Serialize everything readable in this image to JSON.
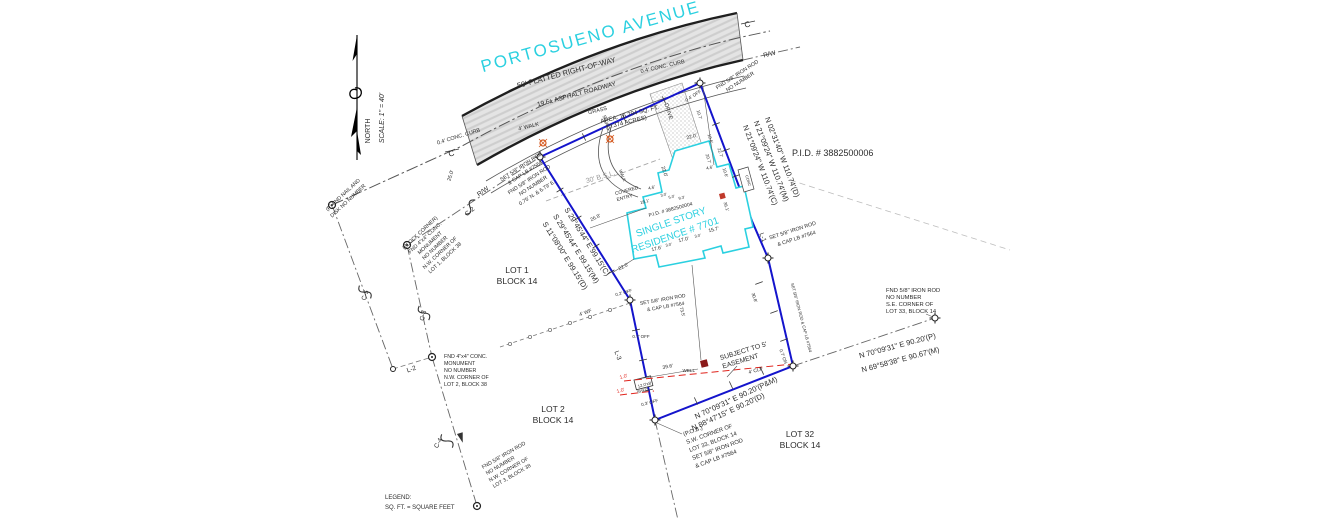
{
  "colors": {
    "ink": "#2b2b2b",
    "grey": "#9a9a9a",
    "cyan": "#2bd0e0",
    "red": "#e0231c",
    "blue": "#1414cc",
    "road_fill": "#e4e4e4",
    "well_fill": "#8b1a1a",
    "ac_fill": "#c0392b",
    "orange": "#d4581e"
  },
  "labels": [
    {
      "n": "road-name",
      "t": "PORTOSUENO AVENUE",
      "x": 592,
      "y": 42,
      "r": -15.5,
      "s": 17,
      "c": "cyan",
      "ls": 2
    },
    {
      "n": "road-row-width",
      "t": "50' PLATTED RIGHT-OF-WAY",
      "x": 567,
      "y": 75,
      "r": -15,
      "s": 7.5
    },
    {
      "n": "road-asphalt",
      "t": "19.6± ASPHALT ROADWAY",
      "x": 577,
      "y": 96,
      "r": -15,
      "s": 6.5
    },
    {
      "n": "curb-note-north",
      "t": "0.4' CONC. CURB",
      "x": 459,
      "y": 138,
      "r": -17,
      "s": 5.5
    },
    {
      "n": "curb-note-south",
      "t": "0.4' CONC. CURB",
      "x": 663,
      "y": 68,
      "r": -13,
      "s": 5.5
    },
    {
      "n": "grass-label",
      "t": "GRASS",
      "x": 598,
      "y": 112,
      "r": -14,
      "s": 5.5
    },
    {
      "n": "walk-label",
      "t": "4' WALK",
      "x": 529,
      "y": 128,
      "r": -14,
      "s": 5.5
    },
    {
      "n": "swale-label",
      "t": "SWALE",
      "x": 605,
      "y": 124,
      "r": 72,
      "s": 5
    },
    {
      "n": "drive-label",
      "t": "DRIVE",
      "x": 667,
      "y": 112,
      "r": 72,
      "s": 5.5
    },
    {
      "n": "north-label",
      "t": "NORTH",
      "x": 370,
      "y": 131,
      "r": -90,
      "s": 7
    },
    {
      "n": "scale-label",
      "t": "SCALE: 1\" = 40'",
      "x": 384,
      "y": 118,
      "r": -90,
      "s": 7,
      "i": 1
    },
    {
      "n": "pid-parcel",
      "t": "P.I.D.  #   3882500006",
      "x": 792,
      "y": 156,
      "s": 9,
      "a": "s"
    },
    {
      "n": "area-line1",
      "t": "AREA: 16,294 SQ. FT.",
      "x": 630,
      "y": 116,
      "r": -14,
      "s": 6
    },
    {
      "n": "area-line2",
      "t": "(0.374 ACRES)",
      "x": 627,
      "y": 124,
      "r": -14,
      "s": 6
    },
    {
      "n": "bsl-label",
      "t": "30' B.S.L.",
      "x": 601,
      "y": 179,
      "r": -16,
      "s": 7,
      "c": "grey"
    },
    {
      "n": "rw-label-ne",
      "t": "R/W",
      "x": 770,
      "y": 56,
      "r": -14,
      "s": 6.5
    },
    {
      "n": "centerline-c-west",
      "t": "C",
      "x": 452,
      "y": 156,
      "r": -15,
      "s": 8
    },
    {
      "n": "centerline-c-east",
      "t": "C",
      "x": 748,
      "y": 27,
      "r": -15,
      "s": 8
    },
    {
      "n": "nw-rod-1",
      "t": "SET 5/8\" IRON ROD",
      "x": 522,
      "y": 168,
      "r": -33,
      "s": 5.3
    },
    {
      "n": "nw-rod-2",
      "t": "& CAP LB #7564",
      "x": 526,
      "y": 174,
      "r": -33,
      "s": 5.3
    },
    {
      "n": "nw-rod-3",
      "t": "FND 5/8\" IRON ROD",
      "x": 530,
      "y": 181,
      "r": -33,
      "s": 5.3
    },
    {
      "n": "nw-rod-4",
      "t": "NO NUMBER",
      "x": 534,
      "y": 187,
      "r": -33,
      "s": 5.3
    },
    {
      "n": "nw-rod-5",
      "t": "0.75' N. & 6.79' E.",
      "x": 538,
      "y": 194,
      "r": -33,
      "s": 5.3
    },
    {
      "n": "rw-label-west",
      "t": "R/W",
      "x": 484,
      "y": 193,
      "r": -35,
      "s": 6.5
    },
    {
      "n": "curve-label-c2",
      "t": "C-2",
      "x": 471,
      "y": 213,
      "r": -40,
      "s": 6.5
    },
    {
      "n": "dim-25",
      "t": "25.0'",
      "x": 452,
      "y": 176,
      "r": -73,
      "s": 5.2
    },
    {
      "n": "nail-disk-1",
      "t": "(P) FND NAIL AND",
      "x": 344,
      "y": 196,
      "r": -43,
      "s": 5.3
    },
    {
      "n": "nail-disk-2",
      "t": "DISK NO NUMBER",
      "x": 349,
      "y": 202,
      "r": -43,
      "s": 5.3
    },
    {
      "n": "block-corner-1",
      "t": "(BLOCK CORNER)",
      "x": 421,
      "y": 234,
      "r": -43,
      "s": 5.3
    },
    {
      "n": "block-corner-2",
      "t": "FND 4\"x4\" CONC.",
      "x": 426,
      "y": 239,
      "r": -43,
      "s": 5.3
    },
    {
      "n": "block-corner-3",
      "t": "MONUMENT",
      "x": 431,
      "y": 244,
      "r": -43,
      "s": 5.3
    },
    {
      "n": "block-corner-4",
      "t": "NO NUMBER",
      "x": 436,
      "y": 249,
      "r": -43,
      "s": 5.3
    },
    {
      "n": "block-corner-5",
      "t": "N.W. CORNER OF",
      "x": 441,
      "y": 254,
      "r": -43,
      "s": 5.3
    },
    {
      "n": "block-corner-6",
      "t": "LOT 1, BLOCK 38",
      "x": 446,
      "y": 259,
      "r": -43,
      "s": 5.3
    },
    {
      "n": "curve-label-c5",
      "t": "C-5",
      "x": 367,
      "y": 296,
      "r": -70,
      "s": 6.5
    },
    {
      "n": "curve-label-c3",
      "t": "C-3",
      "x": 425,
      "y": 316,
      "r": -76,
      "s": 6.5
    },
    {
      "n": "lot2-mon-1",
      "t": "FND 4\"x4\" CONC.",
      "x": 444,
      "y": 358,
      "s": 5.3,
      "a": "s"
    },
    {
      "n": "lot2-mon-2",
      "t": "MONUMENT",
      "x": 444,
      "y": 365,
      "s": 5.3,
      "a": "s"
    },
    {
      "n": "lot2-mon-3",
      "t": "NO NUMBER",
      "x": 444,
      "y": 372,
      "s": 5.3,
      "a": "s"
    },
    {
      "n": "lot2-mon-4",
      "t": "N.W. CORNER OF",
      "x": 444,
      "y": 379,
      "s": 5.3,
      "a": "s"
    },
    {
      "n": "lot2-mon-5",
      "t": "LOT 2, BLOCK 38",
      "x": 444,
      "y": 386,
      "s": 5.3,
      "a": "s"
    },
    {
      "n": "line-label-l2",
      "t": "L-2",
      "x": 412,
      "y": 371,
      "r": -18,
      "s": 6.5
    },
    {
      "n": "curve-label-c4",
      "t": "C-4",
      "x": 440,
      "y": 444,
      "r": -62,
      "s": 6.5
    },
    {
      "n": "lot3-rod-1",
      "t": "FND 5/8\" IRON ROD",
      "x": 483,
      "y": 469,
      "r": -30,
      "s": 5.3,
      "a": "s"
    },
    {
      "n": "lot3-rod-2",
      "t": "NO NUMBER",
      "x": 487,
      "y": 475,
      "r": -30,
      "s": 5.3,
      "a": "s"
    },
    {
      "n": "lot3-rod-3",
      "t": "N.W. CORNER OF",
      "x": 490,
      "y": 482,
      "r": -30,
      "s": 5.3,
      "a": "s"
    },
    {
      "n": "lot3-rod-4",
      "t": "LOT 3, BLOCK 38",
      "x": 494,
      "y": 488,
      "r": -30,
      "s": 5.3,
      "a": "s"
    },
    {
      "n": "legend-title",
      "t": "LEGEND:",
      "x": 385,
      "y": 499,
      "s": 6,
      "a": "s"
    },
    {
      "n": "legend-line",
      "t": "SQ. FT. = SQUARE FEET",
      "x": 385,
      "y": 509,
      "s": 6,
      "a": "s"
    },
    {
      "n": "lot1-label",
      "t": "LOT 1",
      "x": 517,
      "y": 273,
      "s": 8.5
    },
    {
      "n": "lot1-block",
      "t": "BLOCK 14",
      "x": 517,
      "y": 284,
      "s": 8.5
    },
    {
      "n": "lot2-label",
      "t": "LOT 2",
      "x": 553,
      "y": 412,
      "s": 8.5
    },
    {
      "n": "lot2-block",
      "t": "BLOCK 14",
      "x": 553,
      "y": 423,
      "s": 8.5
    },
    {
      "n": "lot32-label",
      "t": "LOT 32",
      "x": 800,
      "y": 437,
      "s": 8.5
    },
    {
      "n": "lot32-block",
      "t": "BLOCK 14",
      "x": 800,
      "y": 448,
      "s": 8.5
    },
    {
      "n": "bearing-west-c",
      "t": "S 29°45'44\" E   99.15'(C)",
      "x": 585,
      "y": 243,
      "r": 58,
      "s": 7.5
    },
    {
      "n": "bearing-west-m",
      "t": "S 29°45'44\" E   99.15'(M)",
      "x": 574,
      "y": 250,
      "r": 58,
      "s": 7.5
    },
    {
      "n": "bearing-west-d",
      "t": "S 11°08'00\" E   99.15'(D)",
      "x": 563,
      "y": 257,
      "r": 58,
      "s": 7.5
    },
    {
      "n": "bearing-east-d",
      "t": "N 02°31'40\" W   110.74'(D)",
      "x": 780,
      "y": 158,
      "r": 69,
      "s": 7.5
    },
    {
      "n": "bearing-east-m",
      "t": "N 21°09'24\" W   110.74'(M)",
      "x": 769,
      "y": 162,
      "r": 69,
      "s": 7.5
    },
    {
      "n": "bearing-east-c",
      "t": "N 21°09'24\" W   110.74'(C)",
      "x": 758,
      "y": 166,
      "r": 69,
      "s": 7.5
    },
    {
      "n": "bearing-south-pm",
      "t": "N 70°09'31\" E   90.20'(P&M)",
      "x": 737,
      "y": 400,
      "r": -25,
      "s": 7.5
    },
    {
      "n": "bearing-south-d",
      "t": "N 88°47'15\" E   90.20'(D)",
      "x": 729,
      "y": 414,
      "r": -25,
      "s": 7.5
    },
    {
      "n": "bearing-se-p",
      "t": "N 70°09'31\" E   90.20'(P)",
      "x": 898,
      "y": 348,
      "r": -15,
      "s": 7.5
    },
    {
      "n": "bearing-se-m",
      "t": "N 69°58'38\" E   90.67'(M)",
      "x": 901,
      "y": 362,
      "r": -15,
      "s": 7.5
    },
    {
      "n": "pob-1",
      "t": "(P.O.B.)",
      "x": 684,
      "y": 436,
      "r": -20,
      "s": 5.8,
      "a": "s"
    },
    {
      "n": "pob-2",
      "t": "S.W. CORNER OF",
      "x": 687,
      "y": 444,
      "r": -20,
      "s": 5.8,
      "a": "s"
    },
    {
      "n": "pob-3",
      "t": "LOT 33, BLOCK 14",
      "x": 690,
      "y": 452,
      "r": -20,
      "s": 5.8,
      "a": "s"
    },
    {
      "n": "pob-4",
      "t": "SET 5/8\" IRON ROD",
      "x": 693,
      "y": 460,
      "r": -20,
      "s": 5.8,
      "a": "s"
    },
    {
      "n": "pob-5",
      "t": "& CAP LB #7564",
      "x": 696,
      "y": 468,
      "r": -20,
      "s": 5.8,
      "a": "s"
    },
    {
      "n": "se-rod-1",
      "t": "FND 5/8\" IRON ROD",
      "x": 886,
      "y": 292,
      "s": 5.8,
      "a": "s"
    },
    {
      "n": "se-rod-2",
      "t": "NO NUMBER",
      "x": 886,
      "y": 299,
      "s": 5.8,
      "a": "s"
    },
    {
      "n": "se-rod-3",
      "t": "S.E. CORNER OF",
      "x": 886,
      "y": 306,
      "s": 5.8,
      "a": "s"
    },
    {
      "n": "se-rod-4",
      "t": "LOT 33, BLOCK 14",
      "x": 886,
      "y": 313,
      "s": 5.8,
      "a": "s"
    },
    {
      "n": "midright-rod-1",
      "t": "SET 5/8\" IRON ROD",
      "x": 793,
      "y": 232,
      "r": -18,
      "s": 5.3
    },
    {
      "n": "midright-rod-2",
      "t": "& CAP LB #7564",
      "x": 797,
      "y": 240,
      "r": -18,
      "s": 5.3
    },
    {
      "n": "line-label-l1",
      "t": "L-1",
      "x": 761,
      "y": 238,
      "r": 70,
      "s": 6.5
    },
    {
      "n": "ne-rod-1",
      "t": "FND 5/8\" IRON ROD",
      "x": 738,
      "y": 76,
      "r": -33,
      "s": 5.3
    },
    {
      "n": "ne-rod-2",
      "t": "NO NUMBER",
      "x": 741,
      "y": 83,
      "r": -33,
      "s": 5.3
    },
    {
      "n": "ne-rod-off",
      "t": "0.4' OFF",
      "x": 694,
      "y": 97,
      "r": -33,
      "s": 4.6
    },
    {
      "n": "easement-1",
      "t": "SUBJECT TO 5'",
      "x": 744,
      "y": 353,
      "r": -17,
      "s": 6.8
    },
    {
      "n": "easement-2",
      "t": "EASEMENT",
      "x": 741,
      "y": 363,
      "r": -17,
      "s": 6.8
    },
    {
      "n": "clf-label",
      "t": "4' CLF",
      "x": 756,
      "y": 372,
      "r": -16,
      "s": 5
    },
    {
      "n": "fence-off-1",
      "t": "1.0'",
      "x": 624,
      "y": 378,
      "r": -15,
      "s": 5,
      "c": "red"
    },
    {
      "n": "fence-off-2",
      "t": "1.0'",
      "x": 621,
      "y": 392,
      "r": -15,
      "s": 5,
      "c": "red"
    },
    {
      "n": "shed-size",
      "t": "12.0'x8'",
      "x": 645,
      "y": 386,
      "r": -14,
      "s": 4.2
    },
    {
      "n": "shed-label",
      "t": "SHED",
      "x": 643,
      "y": 392,
      "r": -14,
      "s": 4.2
    },
    {
      "n": "off-03",
      "t": "0.3' OFF",
      "x": 650,
      "y": 404,
      "r": -15,
      "s": 4.5
    },
    {
      "n": "off-07",
      "t": "0.7' OFF",
      "x": 641,
      "y": 338,
      "s": 4.5
    },
    {
      "n": "on-07",
      "t": "0.7' ON",
      "x": 782,
      "y": 357,
      "r": 70,
      "s": 4.5
    },
    {
      "n": "wf-label",
      "t": "4' WF",
      "x": 586,
      "y": 314,
      "r": -20,
      "s": 5
    },
    {
      "n": "dim-396",
      "t": "39.6'",
      "x": 668,
      "y": 368,
      "r": -11,
      "s": 5
    },
    {
      "n": "well-label",
      "t": "WELL",
      "x": 695,
      "y": 372,
      "s": 4.6,
      "a": "e"
    },
    {
      "n": "dim-735",
      "t": "73.5'",
      "x": 681,
      "y": 312,
      "r": 76,
      "s": 4.6
    },
    {
      "n": "dim-308",
      "t": "30.8'",
      "x": 753,
      "y": 298,
      "r": 72,
      "s": 4.6
    },
    {
      "n": "dim-22-sw",
      "t": "22.0'",
      "x": 624,
      "y": 268,
      "r": -26,
      "s": 5
    },
    {
      "n": "dim-268",
      "t": "26.8'",
      "x": 596,
      "y": 219,
      "r": -26,
      "s": 5
    },
    {
      "n": "dim-22-top",
      "t": "22.0'",
      "x": 692,
      "y": 138,
      "r": -15,
      "s": 5
    },
    {
      "n": "dim-22-left",
      "t": "22.0'",
      "x": 663,
      "y": 172,
      "r": 72,
      "s": 5
    },
    {
      "n": "dim-46-a",
      "t": "4.6'",
      "x": 710,
      "y": 169,
      "r": -15,
      "s": 4.4
    },
    {
      "n": "dim-46-b",
      "t": "4.6'",
      "x": 652,
      "y": 189,
      "r": -15,
      "s": 4.4
    },
    {
      "n": "dim-30-a",
      "t": "3.0'",
      "x": 664,
      "y": 196,
      "r": -15,
      "s": 4
    },
    {
      "n": "dim-50",
      "t": "5.0'",
      "x": 672,
      "y": 198,
      "r": -15,
      "s": 4
    },
    {
      "n": "dim-93",
      "t": "9.3'",
      "x": 682,
      "y": 199,
      "r": -15,
      "s": 4
    },
    {
      "n": "dim-207",
      "t": "20.7'",
      "x": 707,
      "y": 159,
      "r": 72,
      "s": 4.4
    },
    {
      "n": "dim-227",
      "t": "22.7'",
      "x": 719,
      "y": 153,
      "r": 72,
      "s": 4.4
    },
    {
      "n": "dim-106-a",
      "t": "10.6'",
      "x": 724,
      "y": 173,
      "r": 72,
      "s": 4.4
    },
    {
      "n": "dim-106-b",
      "t": "10.6'",
      "x": 709,
      "y": 139,
      "r": 72,
      "s": 4.4
    },
    {
      "n": "dim-107",
      "t": "10.7'",
      "x": 698,
      "y": 115,
      "r": 72,
      "s": 4.4
    },
    {
      "n": "dim-181",
      "t": "18.1'",
      "x": 645,
      "y": 203,
      "r": -15,
      "s": 4.4
    },
    {
      "n": "dim-176",
      "t": "17.6'",
      "x": 657,
      "y": 250,
      "r": -14,
      "s": 5
    },
    {
      "n": "dim-30-b",
      "t": "3.0'",
      "x": 669,
      "y": 246,
      "r": -14,
      "s": 4
    },
    {
      "n": "dim-170",
      "t": "17.0'",
      "x": 684,
      "y": 241,
      "r": -14,
      "s": 5
    },
    {
      "n": "dim-30-c",
      "t": "3.0'",
      "x": 698,
      "y": 237,
      "r": -14,
      "s": 4
    },
    {
      "n": "dim-157",
      "t": "15.7'",
      "x": 714,
      "y": 231,
      "r": -14,
      "s": 5
    },
    {
      "n": "dim-361",
      "t": "36.1'",
      "x": 725,
      "y": 207,
      "r": 72,
      "s": 4.4
    },
    {
      "n": "conc-label",
      "t": "CONC",
      "x": 747,
      "y": 181,
      "r": 72,
      "s": 3.8
    },
    {
      "n": "pid-house",
      "t": "P.I.D. # 3882500004",
      "x": 671,
      "y": 211,
      "r": -15,
      "s": 5
    },
    {
      "n": "residence-1",
      "t": "SINGLE STORY",
      "x": 672,
      "y": 225,
      "r": -19,
      "s": 10,
      "c": "cyan"
    },
    {
      "n": "residence-2",
      "t": "RESIDENCE # 7701",
      "x": 676,
      "y": 238,
      "r": -19,
      "s": 10,
      "c": "cyan"
    },
    {
      "n": "entry-1",
      "t": "COVERED",
      "x": 627,
      "y": 192,
      "r": -15,
      "s": 4.8
    },
    {
      "n": "entry-2",
      "t": "ENTRY",
      "x": 625,
      "y": 199,
      "r": -15,
      "s": 4.8
    },
    {
      "n": "off-02",
      "t": "0.2' OFF",
      "x": 624,
      "y": 294,
      "r": -15,
      "s": 4.4
    },
    {
      "n": "midleft-rod-1",
      "t": "SET 5/8\" IRON ROD",
      "x": 663,
      "y": 301,
      "r": -10,
      "s": 5
    },
    {
      "n": "midleft-rod-2",
      "t": "& CAP LB #7564",
      "x": 666,
      "y": 308,
      "r": -10,
      "s": 5
    },
    {
      "n": "entry-walk-label",
      "t": "WALK",
      "x": 621,
      "y": 176,
      "r": 68,
      "s": 4.4
    },
    {
      "n": "line-label-l3",
      "t": "L-3",
      "x": 616,
      "y": 356,
      "r": 70,
      "s": 6.5
    },
    {
      "n": "east-edge-rod",
      "t": "SET 5/8\" IRON ROD & CAP LB #7564",
      "x": 800,
      "y": 318,
      "r": 75,
      "s": 4.2
    }
  ]
}
